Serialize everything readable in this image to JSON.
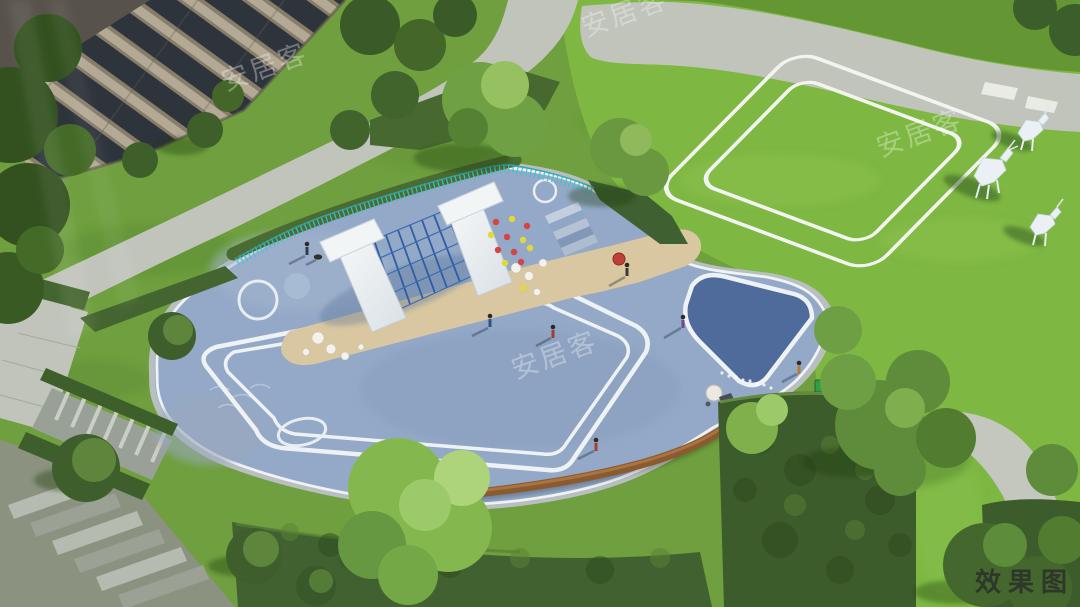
{
  "watermark": {
    "text": "安居客",
    "color": "#ffffff",
    "style": "diagonal-semi-transparent",
    "count": 4
  },
  "corner_label": {
    "text": "效果图",
    "color": "#2b2f2a"
  },
  "scene": {
    "type": "aerial-architectural-rendering",
    "subject": "residential community children playground with lawn",
    "elements": [
      {
        "name": "apartment-building",
        "desc": "beige residential building with dark window bands, top-left"
      },
      {
        "name": "walkway",
        "desc": "light gray curved pedestrian paths"
      },
      {
        "name": "playground",
        "desc": "blue rubber-surface play area with white painted loops and circles"
      },
      {
        "name": "slides",
        "desc": "two white slides flanking a blue climbing net"
      },
      {
        "name": "climbing-wall",
        "desc": "blue surface with red and yellow climbing holds"
      },
      {
        "name": "sand-pit",
        "desc": "tan sand band with white play balls"
      },
      {
        "name": "picket-fence",
        "desc": "teal fence along playground top edge"
      },
      {
        "name": "running-track",
        "desc": "double white looped lane lines on bright lawn"
      },
      {
        "name": "deer-sculptures",
        "desc": "three white geometric deer on the lawn"
      },
      {
        "name": "wood-bench",
        "desc": "curved wooden bench on playground lower edge"
      },
      {
        "name": "hedges",
        "desc": "dark clipped hedge blocks and bands"
      },
      {
        "name": "trees",
        "desc": "scattered green tree canopies"
      },
      {
        "name": "stairs",
        "desc": "stone steps at lower left"
      },
      {
        "name": "people",
        "desc": "small figures of adults and children, one with red umbrella"
      }
    ],
    "palette": {
      "grass": "#6f9f3e",
      "lawn_bright": "#7eb742",
      "corner_grass": "#649733",
      "playground_blue": "#93a9c7",
      "playground_dark_blue": "#4e6b9c",
      "sand": "#d8c7a0",
      "path_gray": "#c0c4bb",
      "track_line": "#f2f5ef",
      "fence_teal": "#3fc4cb",
      "hedge_dark": "#3d5c2b",
      "tree_green": "#5d8f3c",
      "bench_wood": "#8a5a30",
      "slide_white": "#eceff1",
      "building_wall": "#877d6b",
      "building_window": "#2e343b",
      "deer_white": "#eaf0f4"
    }
  }
}
